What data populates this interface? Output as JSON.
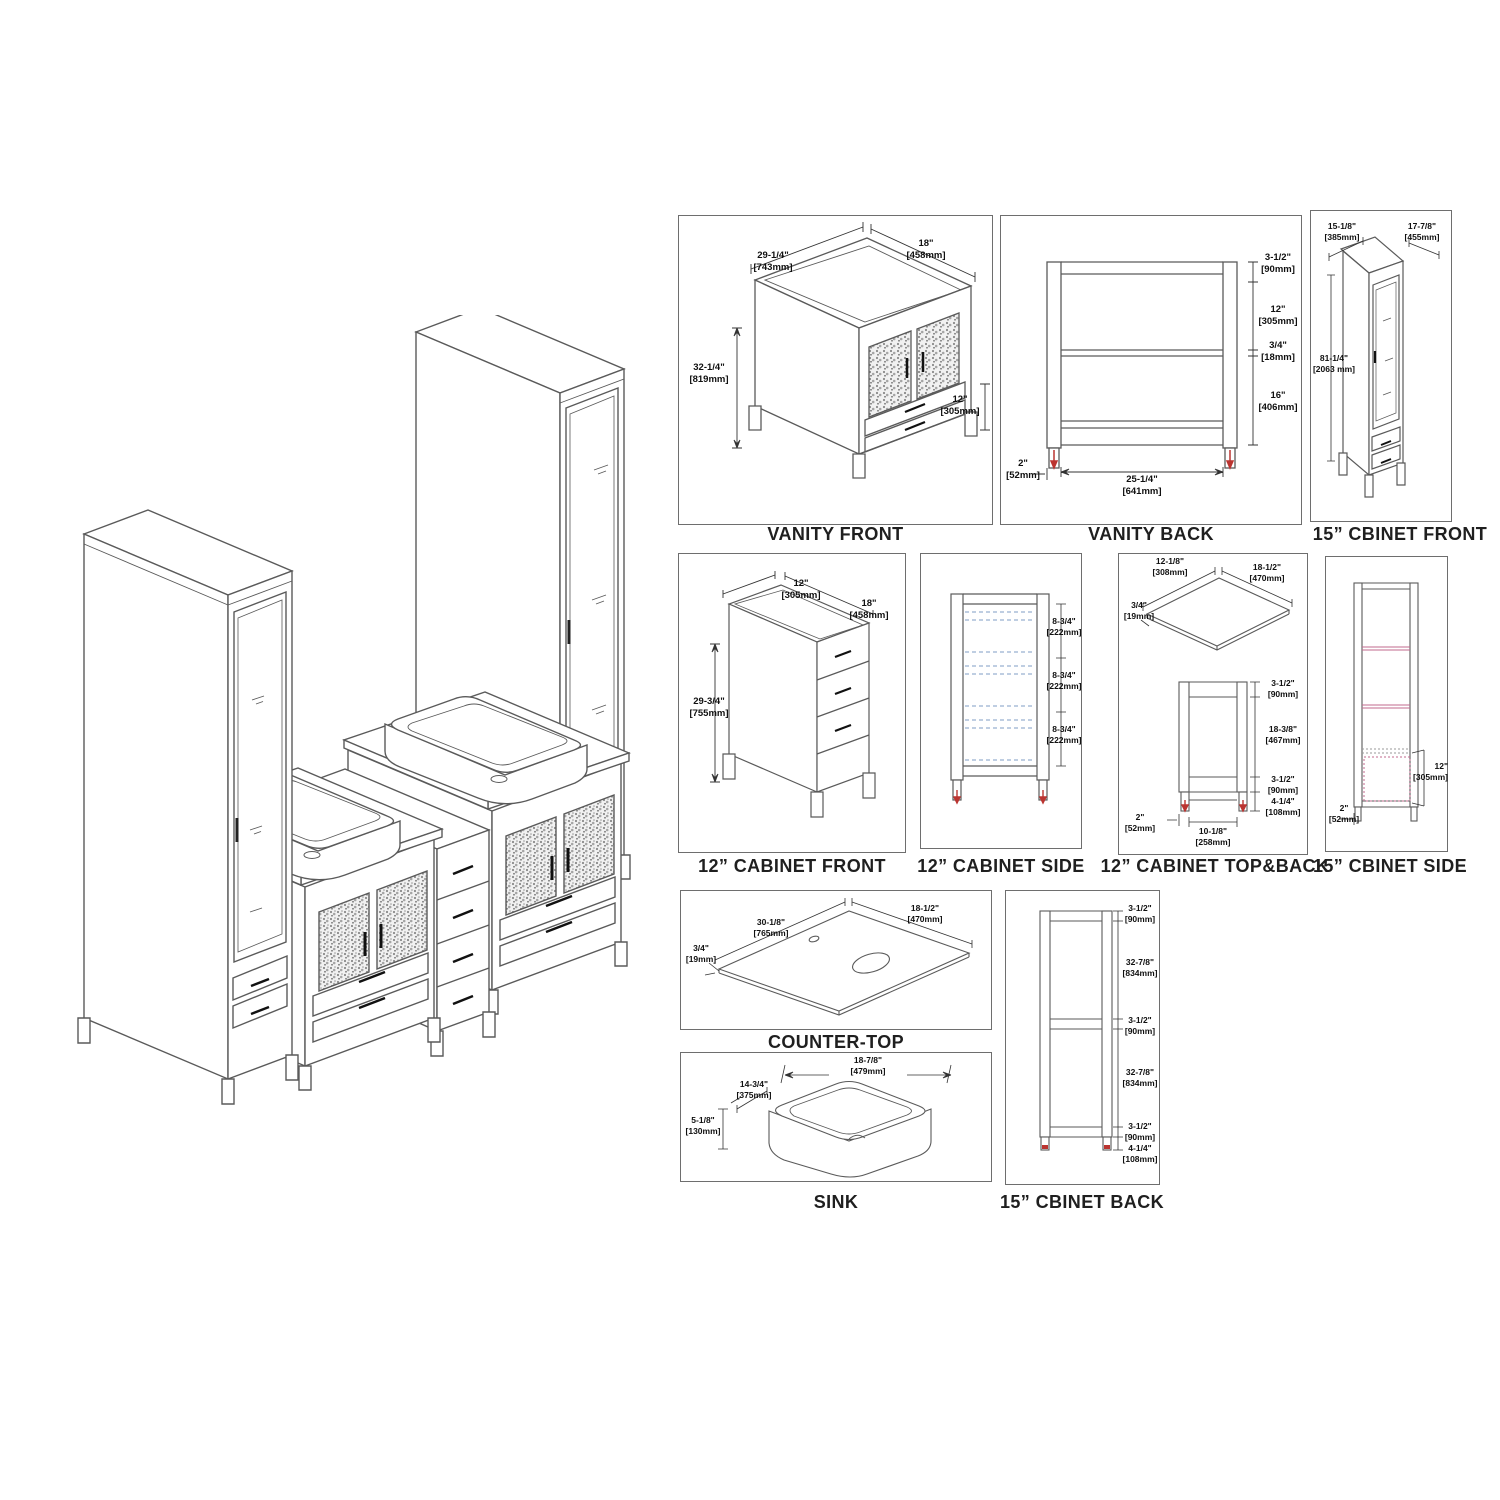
{
  "colors": {
    "line": "#5a5a5a",
    "dim_line": "#333333",
    "dash_blue": "#7f9dc6",
    "pink": "#c2688e",
    "red": "#bb3430",
    "panel_border": "#6e6e6e",
    "label": "#1f1f1f"
  },
  "illustration": {
    "name": "vanity-set-isometric-line-drawing"
  },
  "panels": {
    "vanity_front": {
      "label": "VANITY FRONT",
      "w_in": "29-1/4\"",
      "w_mm": "[743mm]",
      "d_in": "18\"",
      "d_mm": "[458mm]",
      "h_in": "32-1/4\"",
      "h_mm": "[819mm]",
      "dr_in": "12\"",
      "dr_mm": "[305mm]"
    },
    "vanity_back": {
      "label": "VANITY BACK",
      "top_in": "3-1/2\"",
      "top_mm": "[90mm]",
      "mid_in": "12\"",
      "mid_mm": "[305mm]",
      "shelf_in": "3/4\"",
      "shelf_mm": "[18mm]",
      "low_in": "16\"",
      "low_mm": "[406mm]",
      "leg_in": "2\"",
      "leg_mm": "[52mm]",
      "span_in": "25-1/4\"",
      "span_mm": "[641mm]"
    },
    "cbinet15_front": {
      "label": "15” CBINET FRONT",
      "w_in": "15-1/8\"",
      "w_mm": "[385mm]",
      "d_in": "17-7/8\"",
      "d_mm": "[455mm]",
      "h_in": "81-1/4\"",
      "h_mm": "[2063 mm]"
    },
    "cab12_front": {
      "label": "12” CABINET FRONT",
      "w_in": "12\"",
      "w_mm": "[305mm]",
      "d_in": "18\"",
      "d_mm": "[458mm]",
      "h_in": "29-3/4\"",
      "h_mm": "[755mm]"
    },
    "cab12_side": {
      "label": "12” CABINET SIDE",
      "s1_in": "8-3/4\"",
      "s1_mm": "[222mm]",
      "s2_in": "8-3/4\"",
      "s2_mm": "[222mm]",
      "s3_in": "8-3/4\"",
      "s3_mm": "[222mm]"
    },
    "cab12_topback": {
      "label": "12” CABINET TOP&BACK",
      "tw_in": "12-1/8\"",
      "tw_mm": "[308mm]",
      "td_in": "18-1/2\"",
      "td_mm": "[470mm]",
      "tt_in": "3/4\"",
      "tt_mm": "[19mm]",
      "b1_in": "3-1/2\"",
      "b1_mm": "[90mm]",
      "b2_in": "18-3/8\"",
      "b2_mm": "[467mm]",
      "b3_in": "3-1/2\"",
      "b3_mm": "[90mm]",
      "b4_in": "4-1/4\"",
      "b4_mm": "[108mm]",
      "leg_in": "2\"",
      "leg_mm": "[52mm]",
      "span_in": "10-1/8\"",
      "span_mm": "[258mm]"
    },
    "cbinet15_side": {
      "label": "15” CBINET SIDE",
      "niche_in": "12\"",
      "niche_mm": "[305mm]",
      "leg_in": "2\"",
      "leg_mm": "[52mm]"
    },
    "countertop": {
      "label": "COUNTER-TOP",
      "w_in": "30-1/8\"",
      "w_mm": "[765mm]",
      "d_in": "18-1/2\"",
      "d_mm": "[470mm]",
      "t_in": "3/4\"",
      "t_mm": "[19mm]"
    },
    "sink": {
      "label": "SINK",
      "w_in": "18-7/8\"",
      "w_mm": "[479mm]",
      "d_in": "14-3/4\"",
      "d_mm": "[375mm]",
      "h_in": "5-1/8\"",
      "h_mm": "[130mm]"
    },
    "cbinet15_back": {
      "label": "15” CBINET BACK",
      "b1_in": "3-1/2\"",
      "b1_mm": "[90mm]",
      "b2_in": "32-7/8\"",
      "b2_mm": "[834mm]",
      "b3_in": "3-1/2\"",
      "b3_mm": "[90mm]",
      "b4_in": "32-7/8\"",
      "b4_mm": "[834mm]",
      "b5_in": "3-1/2\"",
      "b5_mm": "[90mm]",
      "b6_in": "4-1/4\"",
      "b6_mm": "[108mm]"
    }
  }
}
